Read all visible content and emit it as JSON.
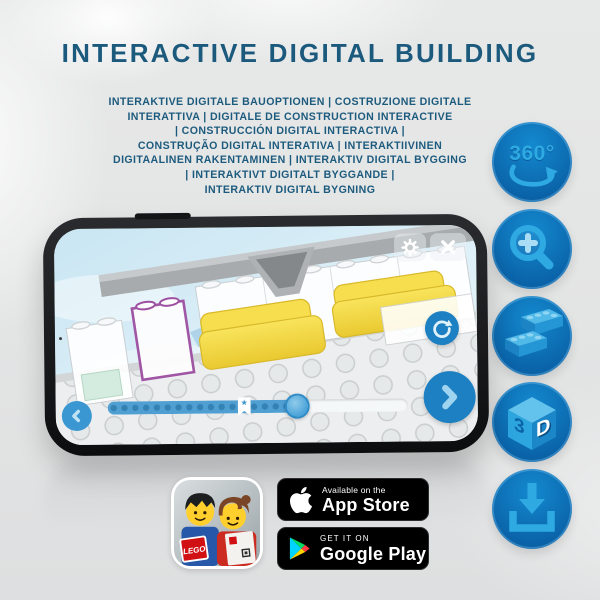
{
  "header": {
    "title": "INTERACTIVE DIGITAL BUILDING",
    "subtitle_lines": [
      "INTERAKTIVE DIGITALE BAUOPTIONEN | COSTRUZIONE DIGITALE",
      "INTERATTIVA | DIGITALE DE CONSTRUCTION INTERACTIVE",
      "| CONSTRUCCIÓN DIGITAL INTERACTIVA |",
      "CONSTRUÇÃO DIGITAL INTERATIVA | INTERAKTIIVINEN",
      "DIGITAALINEN RAKENTAMINEN | INTERAKTIV DIGITAL BYGGING",
      "| INTERAKTIVT DIGITALT BYGGANDE |",
      "INTERAKTIV DIGITAL BYGNING"
    ]
  },
  "feature_icons": {
    "names": [
      "rotate-360",
      "zoom-in",
      "lego-bricks",
      "3d-view",
      "download"
    ],
    "rotation_label": "360°",
    "cube_side_label": "3",
    "cube_front_label": "D"
  },
  "phone": {
    "app_ui": {
      "icon_names": [
        "gear-icon",
        "close-icon",
        "rotate-icon",
        "back-icon",
        "next-icon",
        "bookmark-star-icon"
      ],
      "slider": {
        "flag_star": "★",
        "progress_percent": 63
      },
      "highlighted_piece_outline": "#9d50a1"
    }
  },
  "store_badges": {
    "app_store": {
      "tagline": "Available on the",
      "name": "App Store"
    },
    "google_play": {
      "tagline": "GET IT ON",
      "name": "Google Play"
    }
  },
  "lego_app": {
    "logo_text": "LEGO"
  },
  "colors": {
    "title_text": "#1c5a7d",
    "icon_circle": "#0d6cb0",
    "icon_glyph": "#2fa9e2",
    "screen_sky": "#dff0f7",
    "yellow_bricks": "#f2d844",
    "slider_fill": "#4f9fd3",
    "badge_bg": "#000000"
  }
}
